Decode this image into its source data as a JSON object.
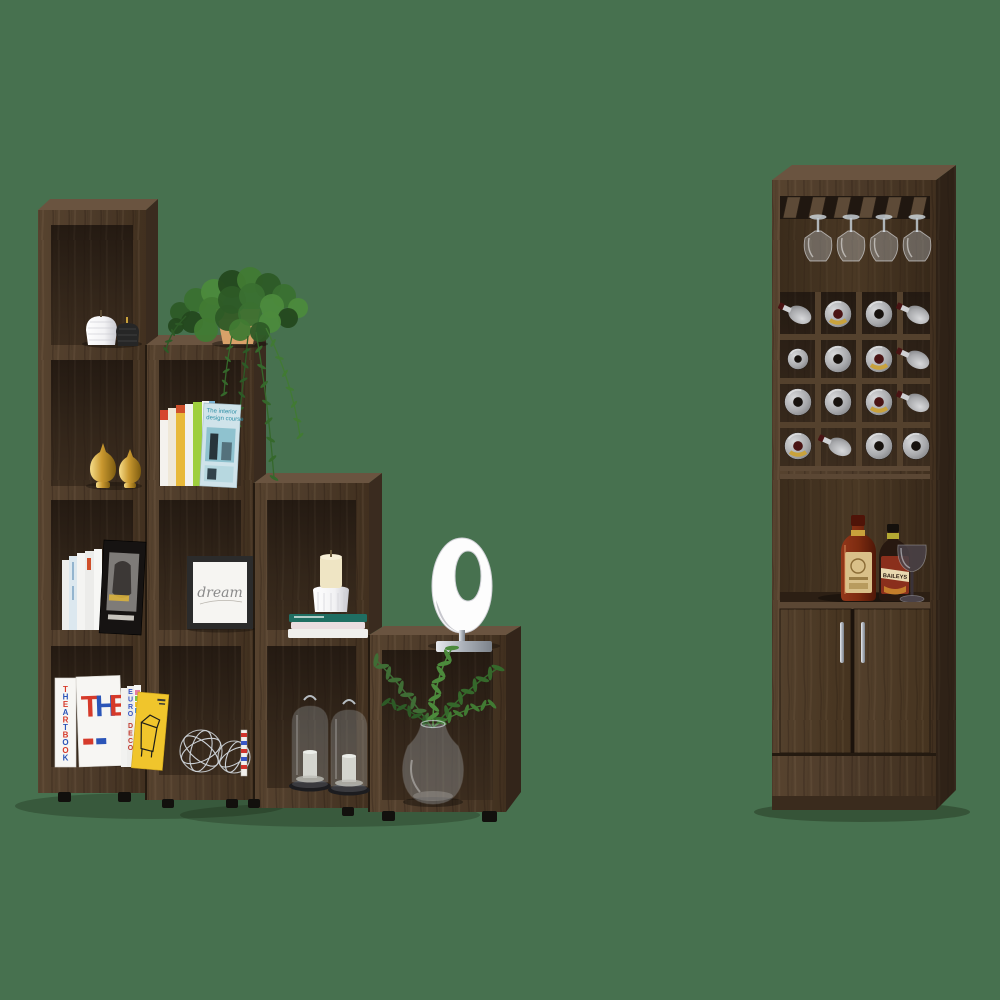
{
  "scene": {
    "type": "furniture-product-photo",
    "background_color": "#47714F",
    "description": "Two-piece dark walnut living set: a four-tier staircase display bookcase decorated with books, plants, candles and ornaments, beside a tall bar cabinet with a stemware rack, a 4x4 wine-bottle cubby grid, a liquor shelf and a two-door lower cabinet."
  },
  "palette": {
    "wood_front": "#4f3d2c",
    "wood_light": "#63503c",
    "wood_interior": "#32251b",
    "wood_side": "#2a1e15",
    "shadow": "#1a140e"
  },
  "ladder_shelf": {
    "name": "staircase bookcase",
    "tiers": 4,
    "decor": {
      "jar_candles": {
        "count": 2,
        "colors": [
          "#eceae6",
          "#262626"
        ]
      },
      "trailing_plant": {
        "pot_color": "#d8a169"
      },
      "gold_finials": {
        "count": 2,
        "color": "#c9982f"
      },
      "design_books": {
        "count": 8,
        "front_cover_title_line1": "The interior",
        "front_cover_title_line2": "design course"
      },
      "framed_print": {
        "text": "dream"
      },
      "pillar_candle": {
        "color": "#efe5c4"
      },
      "stacked_books_count": 3,
      "ring_sculpture": {
        "color": "#ffffff",
        "base_color": "#c0c4c9"
      },
      "art_books": {
        "cover_title": "THE",
        "cover_letter_colors": [
          "#d63a2a",
          "#2b55b8",
          "#d63a2a"
        ],
        "spine_title": "THE ART BOOK",
        "spine_colors": [
          "#d63a2a",
          "#2b55b8"
        ],
        "spine_title_2": "EURO DECO",
        "spine_2_colors": [
          "#3a57c4",
          "#c23a2e"
        ],
        "yellow_book_color": "#f0c52c"
      },
      "wire_spheres": {
        "count": 2,
        "color": "#ccd1d6"
      },
      "glass_cloches": {
        "count": 2
      },
      "glass_vase": {
        "contents": "fern sprigs"
      }
    }
  },
  "bar_cabinet": {
    "name": "tall bar cabinet",
    "stemware_rack": {
      "hanging_glasses": 4,
      "slats": 6
    },
    "wine_grid": {
      "rows": 4,
      "cols": 4,
      "bottles": [
        {
          "row": 0,
          "col": 0,
          "style": "angled",
          "label": false
        },
        {
          "row": 0,
          "col": 1,
          "style": "front",
          "label": true
        },
        {
          "row": 0,
          "col": 2,
          "style": "front",
          "label": false
        },
        {
          "row": 0,
          "col": 3,
          "style": "angled",
          "label": false
        },
        {
          "row": 1,
          "col": 0,
          "style": "front_small",
          "label": false
        },
        {
          "row": 1,
          "col": 1,
          "style": "front",
          "label": false
        },
        {
          "row": 1,
          "col": 2,
          "style": "front",
          "label": true
        },
        {
          "row": 1,
          "col": 3,
          "style": "angled",
          "label": false
        },
        {
          "row": 2,
          "col": 0,
          "style": "front",
          "label": false
        },
        {
          "row": 2,
          "col": 1,
          "style": "front",
          "label": false
        },
        {
          "row": 2,
          "col": 2,
          "style": "front",
          "label": true
        },
        {
          "row": 2,
          "col": 3,
          "style": "angled",
          "label": false
        },
        {
          "row": 3,
          "col": 0,
          "style": "front",
          "label": true
        },
        {
          "row": 3,
          "col": 1,
          "style": "angled",
          "label": false
        },
        {
          "row": 3,
          "col": 2,
          "style": "front",
          "label": false
        },
        {
          "row": 3,
          "col": 3,
          "style": "front",
          "label": false
        }
      ]
    },
    "shelf_items": {
      "whisky_bottle": {
        "body_color": "#7d2b10",
        "label_color": "#d9c089"
      },
      "cream_liqueur_bottle": {
        "label_text": "BAILEYS",
        "label_color": "#8a2f1c"
      },
      "wine_glasses": 1
    },
    "doors": {
      "count": 2,
      "handle_color": "#c9ccd1"
    }
  }
}
